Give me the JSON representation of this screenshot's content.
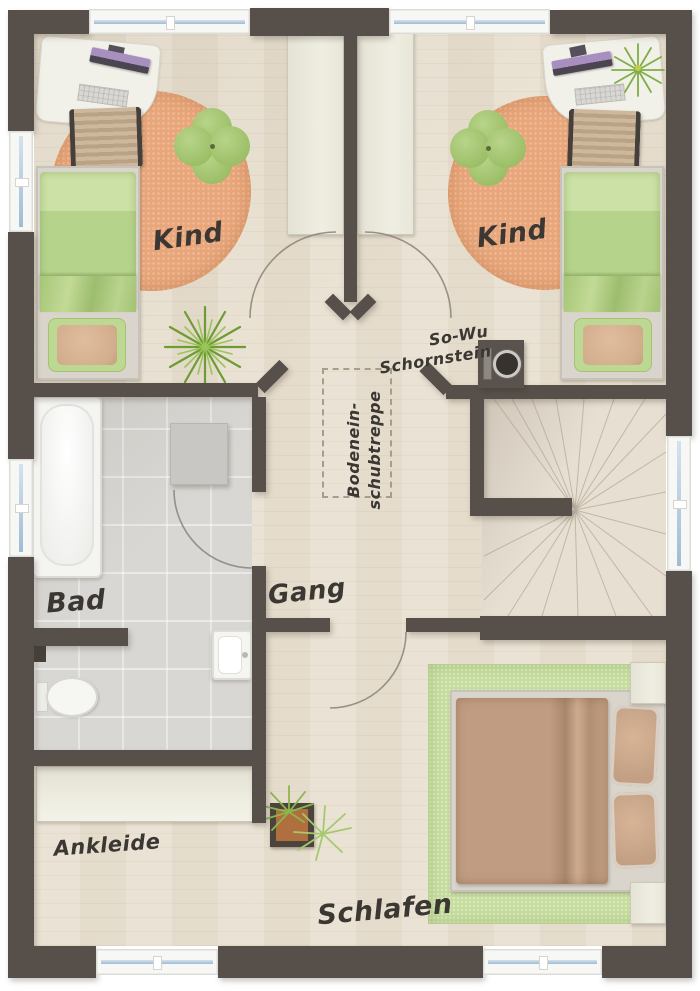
{
  "labels": {
    "kind_left": "Kind",
    "kind_right": "Kind",
    "bad": "Bad",
    "gang": "Gang",
    "ankleide": "Ankleide",
    "schlafen": "Schlafen",
    "chimney_line1": "So-Wu",
    "chimney_line2": "Schornstein",
    "attic_line1": "Bodenein-",
    "attic_line2": "schubtreppe"
  },
  "colors": {
    "wall": "#57504a",
    "wood_floor": "#e9e1d2",
    "tile_floor": "#d9d7d3",
    "rug_orange": "#e8a67a",
    "rug_green": "#c6dd9e",
    "bed_green": "#b6d38c",
    "bed_brown": "#c09d82",
    "furniture_white": "#f1f0e9",
    "window_glass": "#9fbcd4",
    "text": "#3b3733"
  }
}
